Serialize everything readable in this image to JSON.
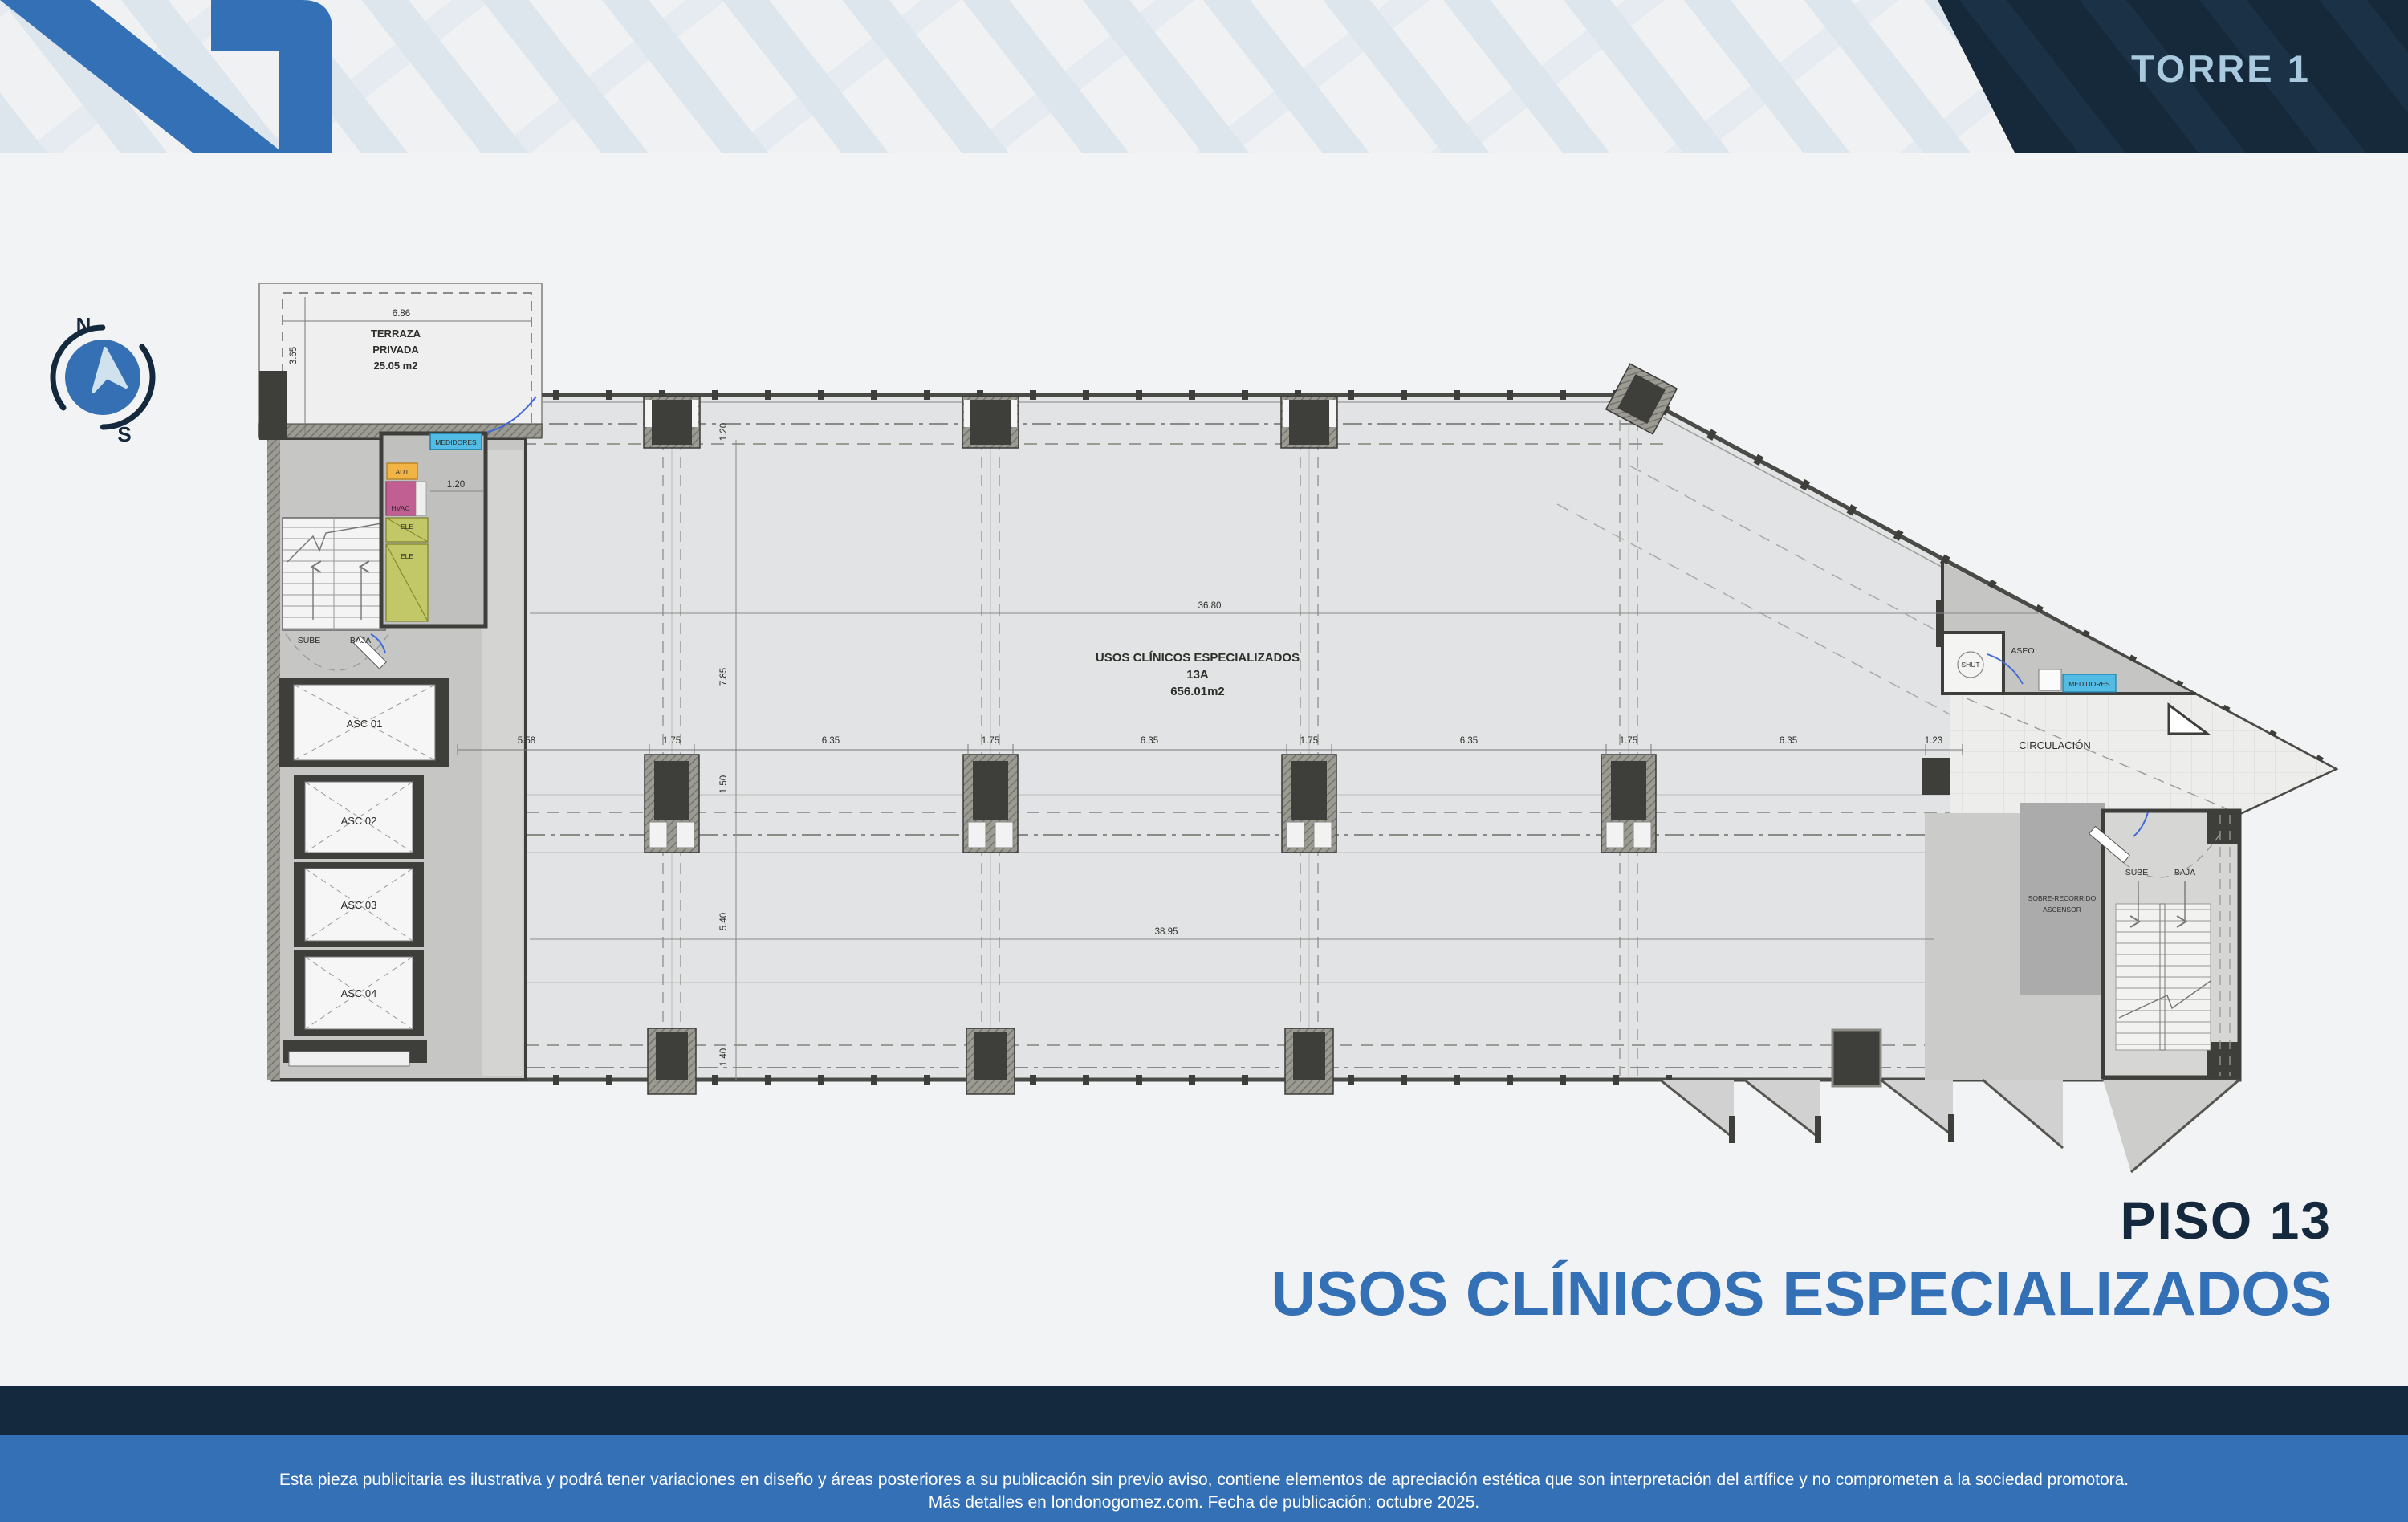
{
  "banner": {
    "tower_label": "TORRE 1"
  },
  "compass": {
    "north": "N",
    "south": "S"
  },
  "plan": {
    "terraza": {
      "line1": "TERRAZA",
      "line2": "PRIVADA",
      "line3": "25.05 m2",
      "width_dim": "6.86",
      "height_dim": "3.65"
    },
    "services": {
      "medidores": "MEDIDORES",
      "aut": "AUT",
      "hvac": "HVAC",
      "ele_top": "ELE",
      "ele_bottom": "ELE",
      "corridor_dim": "1.20"
    },
    "stairs_left": {
      "up": "SUBE",
      "down": "BAJA"
    },
    "elevators": [
      "ASC 01",
      "ASC 02",
      "ASC 03",
      "ASC 04"
    ],
    "main_space": {
      "title": "USOS CLÍNICOS ESPECIALIZADOS",
      "unit": "13A",
      "area": "656.01m2"
    },
    "dims": {
      "top": "36.80",
      "bottom": "38.95",
      "row": [
        "5.58",
        "1.75",
        "6.35",
        "1.75",
        "6.35",
        "1.75",
        "6.35",
        "1.75",
        "6.35",
        "1.23"
      ],
      "left": [
        "1.20",
        "7.85",
        "1.50",
        "5.40",
        "1.40"
      ]
    },
    "right_zone": {
      "circulation": "CIRCULACIÓN",
      "aseo": "ASEO",
      "shut": "SHUT",
      "medidores": "MEDIDORES",
      "over_travel_line1": "SOBRE-RECORRIDO",
      "over_travel_line2": "ASCENSOR",
      "up": "SUBE",
      "down": "BAJA"
    }
  },
  "title": {
    "floor": "PISO 13",
    "use": "USOS CLÍNICOS ESPECIALIZADOS"
  },
  "footer": {
    "line1": "Esta pieza publicitaria es ilustrativa y podrá tener variaciones en diseño y áreas posteriores a su publicación sin previo aviso, contiene elementos de apreciación estética que son interpretación del artífice y no comprometen a la sociedad promotora.",
    "line2": "Más detalles en londonogomez.com. Fecha de publicación: octubre 2025."
  },
  "colors": {
    "accent_blue": "#3470B5",
    "navy": "#14293D",
    "banner_text": "#A9CADE",
    "pattern_blue": "#DCE6ED",
    "cyan_box": "#53BCE4",
    "orange_box": "#F2B445",
    "pink_box": "#C25F92",
    "olive_box": "#C2C868",
    "plan_fill": "#E2E3E4"
  }
}
